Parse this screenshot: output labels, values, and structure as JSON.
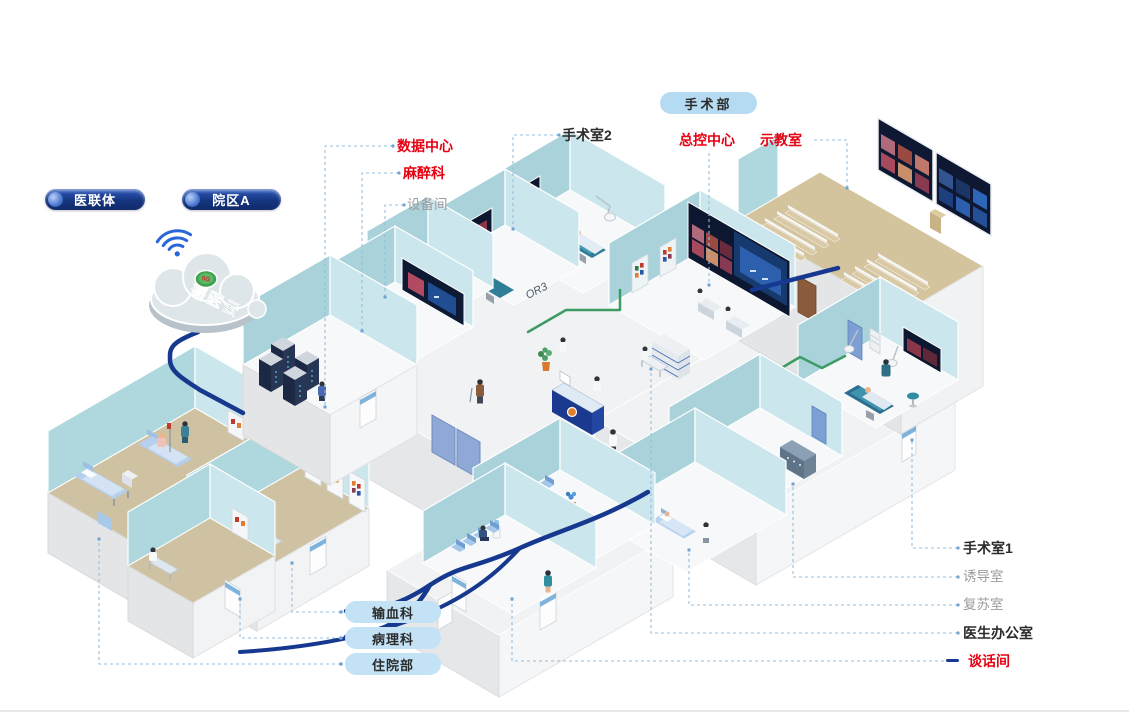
{
  "pills": {
    "surgery_dept": "手术部",
    "alliance": "医联体",
    "campus": "院区A",
    "bottom": [
      {
        "label": "输血科"
      },
      {
        "label": "病理科"
      },
      {
        "label": "住院部"
      }
    ]
  },
  "cloud": {
    "title": "德医云",
    "badge": "5G"
  },
  "callouts": {
    "data_center": {
      "label": "数据中心",
      "style": "red"
    },
    "anesthesia": {
      "label": "麻醉科",
      "style": "red"
    },
    "equipment": {
      "label": "设备间",
      "style": "gray"
    },
    "or2": {
      "label": "手术室2",
      "style": "dark"
    },
    "master_control": {
      "label": "总控中心",
      "style": "red"
    },
    "demo_room": {
      "label": "示教室",
      "style": "red"
    },
    "or1": {
      "label": "手术室1",
      "style": "dark"
    },
    "induction": {
      "label": "诱导室",
      "style": "gray"
    },
    "recovery": {
      "label": "复苏室",
      "style": "gray"
    },
    "doctor_office": {
      "label": "医生办公室",
      "style": "dark"
    },
    "talk_room": {
      "label": "谈话间",
      "style": "red"
    }
  },
  "wall_marks": {
    "or2": "OR2",
    "or3": "OR3"
  },
  "colors": {
    "label_red": "#e60012",
    "label_gray": "#9b9ba0",
    "label_dark": "#2b2b2b",
    "network_navy": "#16388e",
    "cable_green": "#3d9b64",
    "leader_blue": "#93bede",
    "wall_teal": "#a9d2da",
    "wall_teal_light": "#cbe6ec",
    "floor_tan": "#cfc2a2",
    "pill_light_blue": "#b5dbf2",
    "pill_navy": "#17357f",
    "screen_navy": "#0d1730"
  }
}
